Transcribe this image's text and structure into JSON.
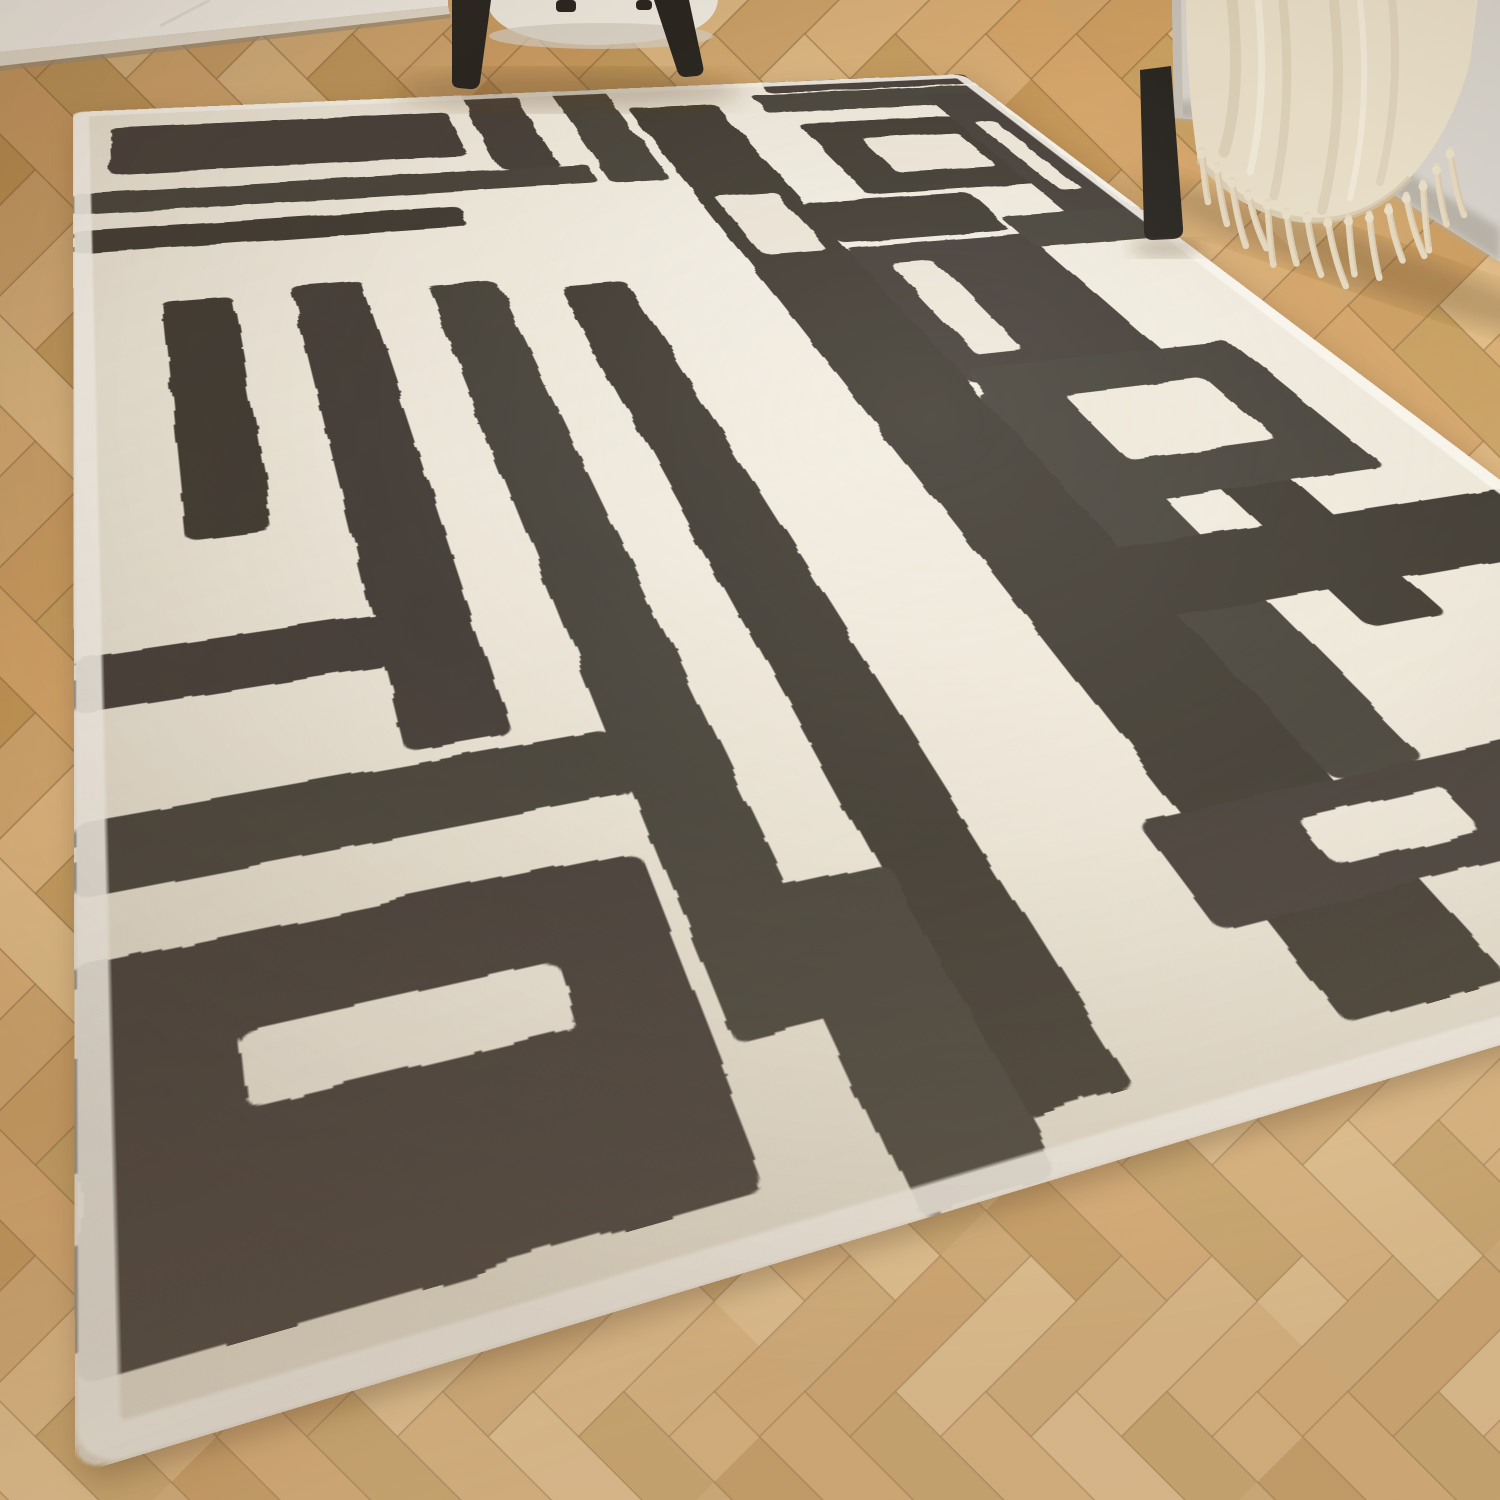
{
  "scene": {
    "description": "Bright product photograph of a cream rectangular rug with a bold abstract charcoal line-maze pattern, laid diagonally on light oak herringbone parquet. A white wall corner shows top-left, a cream boucle armchair with black metal legs stands top-centre, and a light grey sofa draped with a fringed cream throw blanket sits top-right.",
    "objects": [
      "wall-corner",
      "wood-floor",
      "abstract-rug",
      "armchair",
      "sofa",
      "throw-blanket"
    ]
  },
  "palette": {
    "wall": "#f2efe8",
    "baseboard": "#e2dbcd",
    "baseboard_shadow": "#9a8e7c",
    "floor_seam": "rgba(122,88,50,0.32)",
    "rug_cream": "#efe9dc",
    "rug_cream_hi": "#f7f2e8",
    "rug_cream_lo": "#e3dccb",
    "rug_edge": "#f8f5ee",
    "rug_charcoal": "#46403a",
    "rug_charcoal_2": "#4a443c",
    "rug_charcoal_3": "#423c36",
    "sofa": "#d7d3cc",
    "sofa_hi": "#dedad3",
    "sofa_lo": "#b3ada2",
    "metal": "#26231f",
    "chair_cushion": "#f0ece3",
    "chair_cushion_lo": "#d6cfc1",
    "throw": "#e9dfc9",
    "throw_hi": "#f3ecdc",
    "throw_lo": "#d2c5aa",
    "tassel": "#e5d8bf",
    "shadow": "rgba(92,64,36,0.30)"
  },
  "floor": {
    "plank_width": 64,
    "plank_length": 192,
    "rotation_deg": 45,
    "tones": [
      "#d7a76b",
      "#cfa063",
      "#dcb076",
      "#c79858",
      "#e0b77f",
      "#caa162",
      "#d3a86e",
      "#c08f50",
      "#e4bf88"
    ]
  },
  "rug": {
    "space": [
      900,
      1300
    ],
    "corners": [
      [
        73,
        112
      ],
      [
        963,
        74
      ],
      [
        2035,
        884
      ],
      [
        75,
        1475
      ]
    ],
    "border_inset": 7,
    "border_width": 13,
    "charcoal_shapes": [
      {
        "x": 30,
        "y": 48,
        "w": 300,
        "h": 118
      },
      {
        "x": 0,
        "y": 205,
        "w": 430,
        "h": 46
      },
      {
        "x": 0,
        "y": 285,
        "w": 300,
        "h": 44
      },
      {
        "x": 350,
        "y": 0,
        "w": 54,
        "h": 205
      },
      {
        "x": 440,
        "y": 0,
        "w": 54,
        "h": 253
      },
      {
        "x": 60,
        "y": 430,
        "w": 48,
        "h": 330
      },
      {
        "x": 150,
        "y": 420,
        "w": 52,
        "h": 560
      },
      {
        "x": 248,
        "y": 440,
        "w": 52,
        "h": 760
      },
      {
        "x": 345,
        "y": 460,
        "w": 54,
        "h": 810
      },
      {
        "x": 0,
        "y": 860,
        "w": 190,
        "h": 48
      },
      {
        "x": 0,
        "y": 990,
        "w": 250,
        "h": 50
      },
      {
        "x": 505,
        "y": 60,
        "w": 90,
        "h": 1210
      },
      {
        "x": 595,
        "y": 430,
        "w": 170,
        "h": 250
      },
      {
        "x": 595,
        "y": 700,
        "w": 60,
        "h": 430
      },
      {
        "x": 700,
        "y": 720,
        "w": 55,
        "h": 300
      },
      {
        "x": 480,
        "y": 1130,
        "w": 280,
        "h": 75
      },
      {
        "x": 640,
        "y": 38,
        "w": 260,
        "h": 56
      },
      {
        "x": 660,
        "y": 130,
        "w": 200,
        "h": 190
      },
      {
        "x": 825,
        "y": 60,
        "w": 68,
        "h": 360
      },
      {
        "x": 600,
        "y": 660,
        "w": 230,
        "h": 200
      },
      {
        "x": 560,
        "y": 905,
        "w": 340,
        "h": 75
      },
      {
        "x": 0,
        "y": 1080,
        "w": 240,
        "h": 190
      },
      {
        "x": 290,
        "y": 1120,
        "w": 60,
        "h": 180
      },
      {
        "x": 595,
        "y": 330,
        "w": 160,
        "h": 90
      },
      {
        "x": 660,
        "y": 0,
        "w": 240,
        "h": 34
      },
      {
        "x": 760,
        "y": 390,
        "w": 140,
        "h": 70
      }
    ],
    "cream_windows": [
      {
        "x": 708,
        "y": 178,
        "w": 104,
        "h": 94
      },
      {
        "x": 655,
        "y": 712,
        "w": 120,
        "h": 96
      },
      {
        "x": 560,
        "y": 1150,
        "w": 90,
        "h": 35
      },
      {
        "x": 60,
        "y": 1135,
        "w": 130,
        "h": 38
      },
      {
        "x": 845,
        "y": 150,
        "w": 22,
        "h": 190
      },
      {
        "x": 522,
        "y": 300,
        "w": 56,
        "h": 130
      },
      {
        "x": 620,
        "y": 470,
        "w": 40,
        "h": 170
      }
    ]
  },
  "throw": {
    "tassel_count": 15,
    "edge_points": [
      [
        1202,
        150
      ],
      [
        1240,
        188
      ],
      [
        1284,
        210
      ],
      [
        1332,
        220
      ],
      [
        1380,
        212
      ],
      [
        1420,
        186
      ],
      [
        1450,
        150
      ]
    ]
  }
}
